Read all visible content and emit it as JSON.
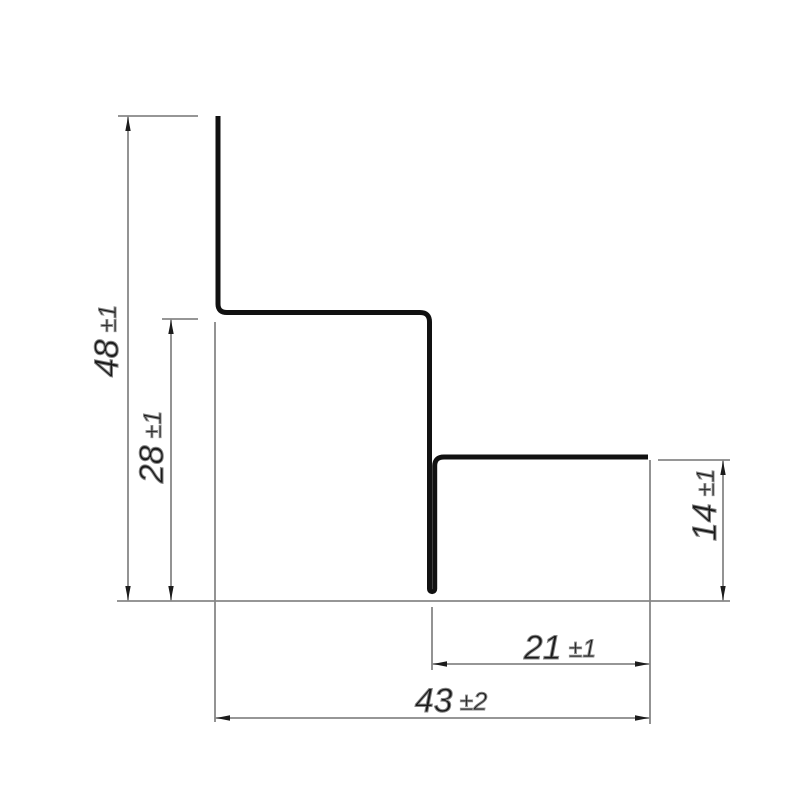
{
  "drawing": {
    "kind": "stepped profile cross-section with dimensions",
    "dimensions": {
      "total_height": {
        "value": "48",
        "tolerance": "±1"
      },
      "step_height": {
        "value": "28",
        "tolerance": "±1"
      },
      "right_height": {
        "value": "14",
        "tolerance": "±1"
      },
      "step_width": {
        "value": "21",
        "tolerance": "±1"
      },
      "total_width": {
        "value": "43",
        "tolerance": "±2"
      }
    },
    "colors": {
      "background": "#ffffff",
      "profile": "#111111",
      "dimension_lines": "#878787",
      "arrows": "#1c1c1c",
      "text": "#1a1a1a"
    }
  }
}
